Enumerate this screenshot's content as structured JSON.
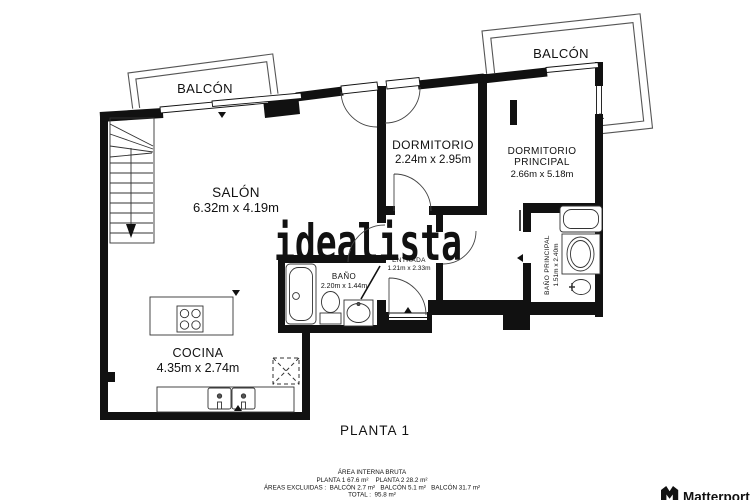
{
  "plan": {
    "floor_title": "PLANTA 1",
    "watermark": "idealista",
    "brand": "Matterport",
    "colors": {
      "wall": "#111111",
      "watermark": "#cecece",
      "background": "#ffffff",
      "balcony_line": "#555555"
    },
    "rooms": {
      "balcony_left": {
        "name": "BALCÓN"
      },
      "balcony_right": {
        "name": "BALCÓN"
      },
      "salon": {
        "name": "SALÓN",
        "dims": "6.32m x 4.19m"
      },
      "dormitorio": {
        "name": "DORMITORIO",
        "dims": "2.24m x 2.95m"
      },
      "dormitorio_principal": {
        "name_line1": "DORMITORIO",
        "name_line2": "PRINCIPAL",
        "dims": "2.66m x 5.18m"
      },
      "bano": {
        "name": "BAÑO",
        "dims": "2.20m x 1.44m"
      },
      "entrada": {
        "name": "ENTRADA",
        "dims": "1.21m x 2.33m"
      },
      "bano_principal": {
        "name": "BAÑO PRINCIPAL",
        "dims": "1.51m x 2.40m"
      },
      "cocina": {
        "name": "COCINA",
        "dims": "4.35m x 2.74m"
      }
    },
    "summary": {
      "title": "ÁREA INTERNA BRUTA",
      "plantas": "PLANTA 1 67.6 m²    PLANTA 2 28.2 m²",
      "excluidas": "ÁREAS EXCLUIDAS :  BALCÓN 2.7 m²   BALCÓN 5.1 m²   BALCÓN 31.7 m²",
      "total": "TOTAL :  95.8 m²"
    }
  }
}
